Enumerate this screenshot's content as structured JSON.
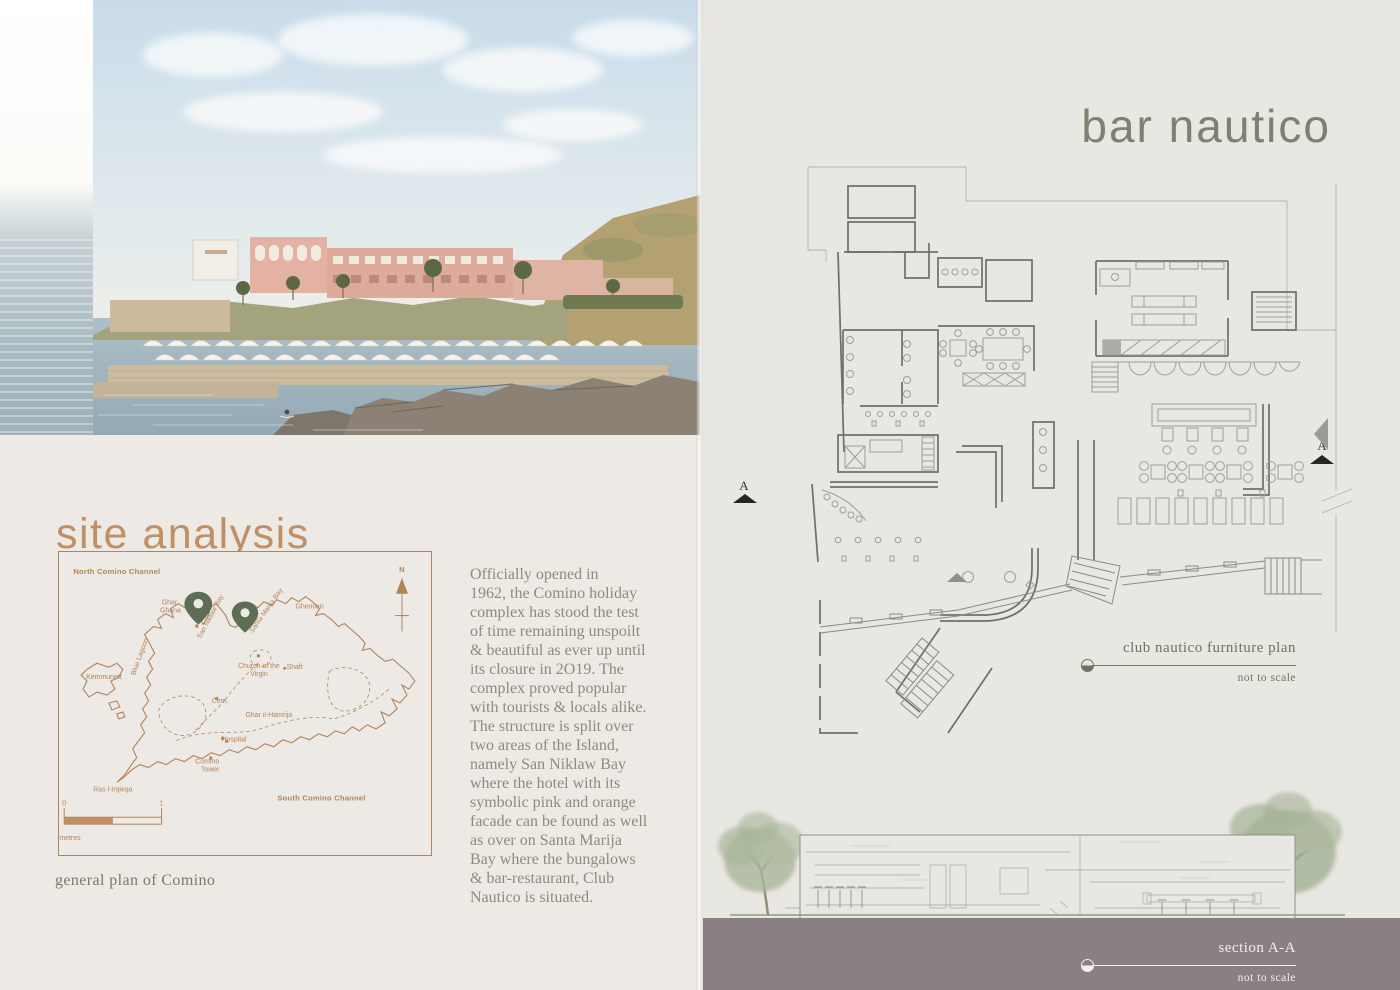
{
  "left_page": {
    "title": "site analysis",
    "map": {
      "caption": "general plan of Comino",
      "compass_label": "N",
      "scale": {
        "start_label": "0",
        "end_label": "1",
        "unit_label": "Kilometres"
      },
      "labels": [
        {
          "text": "North Comino Channel",
          "x": 58,
          "y": 22,
          "cls": "lbl-bold",
          "anchor": "start"
        },
        {
          "text": "South Comino Channel",
          "x": 264,
          "y": 250,
          "cls": "lbl-bold",
          "anchor": "start"
        },
        {
          "text": "Ghar",
          "x": 111,
          "y": 53
        },
        {
          "text": "Ghana",
          "x": 112,
          "y": 61
        },
        {
          "text": "San Niklaw Bay",
          "x": 154,
          "y": 66,
          "rot": -62
        },
        {
          "text": "Santa Marija Bay",
          "x": 210,
          "y": 60,
          "rot": -55
        },
        {
          "text": "Ghemieri",
          "x": 252,
          "y": 57
        },
        {
          "text": "Blue Lagoon",
          "x": 83,
          "y": 106,
          "rot": -70
        },
        {
          "text": "Kemmunett",
          "x": 45,
          "y": 128,
          "anchor": "start"
        },
        {
          "text": "Church of the",
          "x": 201,
          "y": 117
        },
        {
          "text": "Virgin",
          "x": 201,
          "y": 125
        },
        {
          "text": "Shaft",
          "x": 237,
          "y": 118
        },
        {
          "text": "Cem.",
          "x": 162,
          "y": 152
        },
        {
          "text": "Ghar il-Hamrija",
          "x": 211,
          "y": 166
        },
        {
          "text": "Hospital",
          "x": 176,
          "y": 191
        },
        {
          "text": "Comino",
          "x": 149,
          "y": 213
        },
        {
          "text": "Tower",
          "x": 152,
          "y": 221
        },
        {
          "text": "Ras l-Irqieqa",
          "x": 54,
          "y": 241,
          "anchor": "start"
        }
      ]
    },
    "paragraph_lines": [
      "Officially opened in",
      "1962, the Comino holiday",
      "complex has stood the test",
      "of time remaining unspoilt",
      "& beautiful as ever up until",
      "its closure in 2O19. The",
      "complex proved popular",
      "with tourists & locals alike.",
      "The structure is split over",
      "two areas of the Island,",
      "namely San Niklaw Bay",
      "where the hotel with its",
      "symbolic pink and orange",
      "facade can be found as well",
      "as over on Santa Marija",
      "Bay where the bungalows",
      "& bar-restaurant, Club",
      "Nautico is situated."
    ]
  },
  "right_page": {
    "title": "bar nautico",
    "plan_caption": {
      "title": "club nautico furniture plan",
      "subtitle": "not to scale"
    },
    "section_caption": {
      "title": "section A-A",
      "subtitle": "not to scale"
    },
    "plan_markers": {
      "left": "A",
      "right": "A"
    }
  },
  "colors": {
    "accent_tan": "#c08f63",
    "map_brown": "#b1845a",
    "pin_green": "#5d6e54",
    "sage_title": "#7d8170",
    "olive_label": "#6f7265",
    "mauve_band": "#8a7f83",
    "body_text": "#8b8b7f"
  }
}
